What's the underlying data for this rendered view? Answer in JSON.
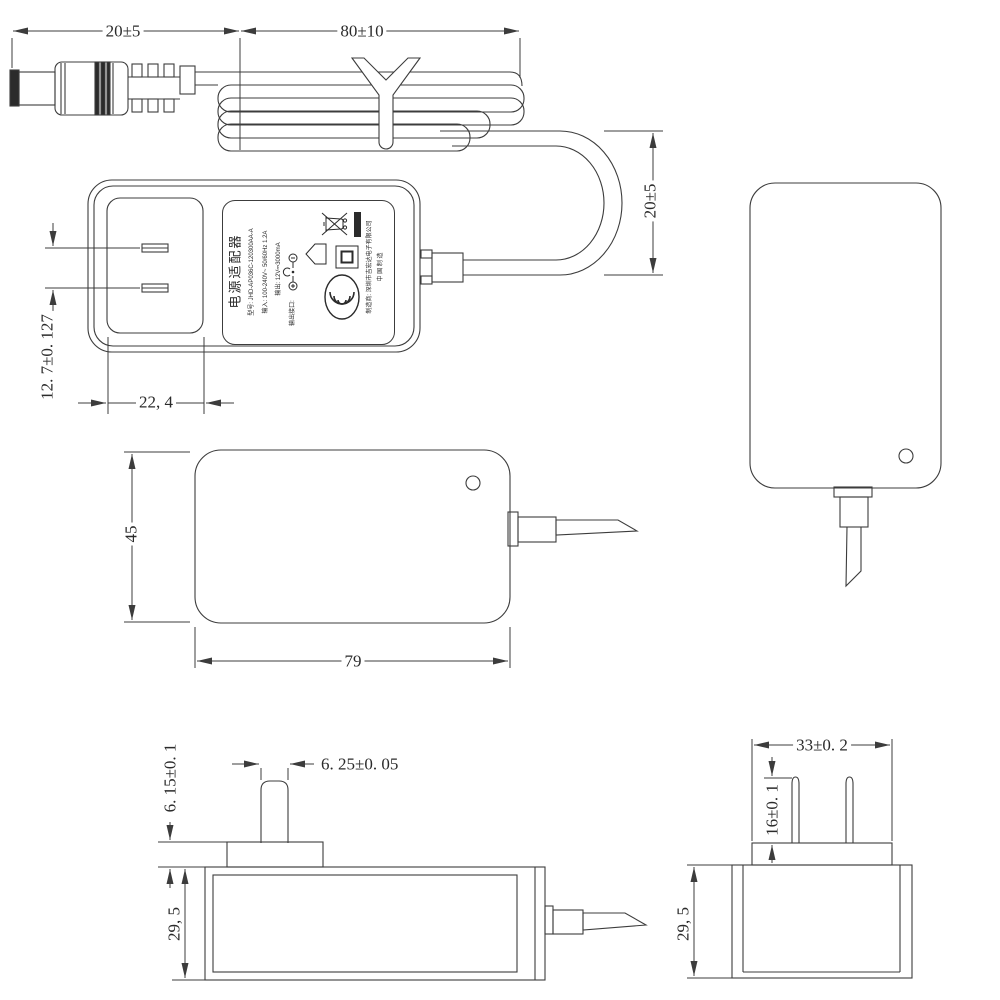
{
  "style": {
    "background": "#ffffff",
    "line_color": "#3c3c3c",
    "text_color": "#2b2b2b"
  },
  "dimensions": {
    "plug_cable_length": "20±5",
    "coiled_cable_length": "80±10",
    "cable_loop_height": "20±5",
    "blade_pitch": "12. 7±0. 127",
    "plug_recess_width": "22, 4",
    "body_width": "45",
    "body_length": "79",
    "blade_tip_width": "6. 25±0. 05",
    "plug_face_height": "6. 15±0. 1",
    "body_thickness_left_view": "29, 5",
    "plug_face_width": "33±0. 2",
    "blade_length": "16±0. 1",
    "body_thickness_right_view": "29, 5"
  },
  "label": {
    "title": "电源适配器",
    "model_line": "型号: JHD-AP036C-120300AA-A",
    "input_line": "输入: 100-240V~ 50/60Hz 1.2A",
    "output_line": "输出: 12V⎓3000mA",
    "port_line": "输出接口:",
    "manufacturer_line": "制造商: 深圳市吉宏达电子有限公司",
    "made_in": "中 国 制 造"
  }
}
